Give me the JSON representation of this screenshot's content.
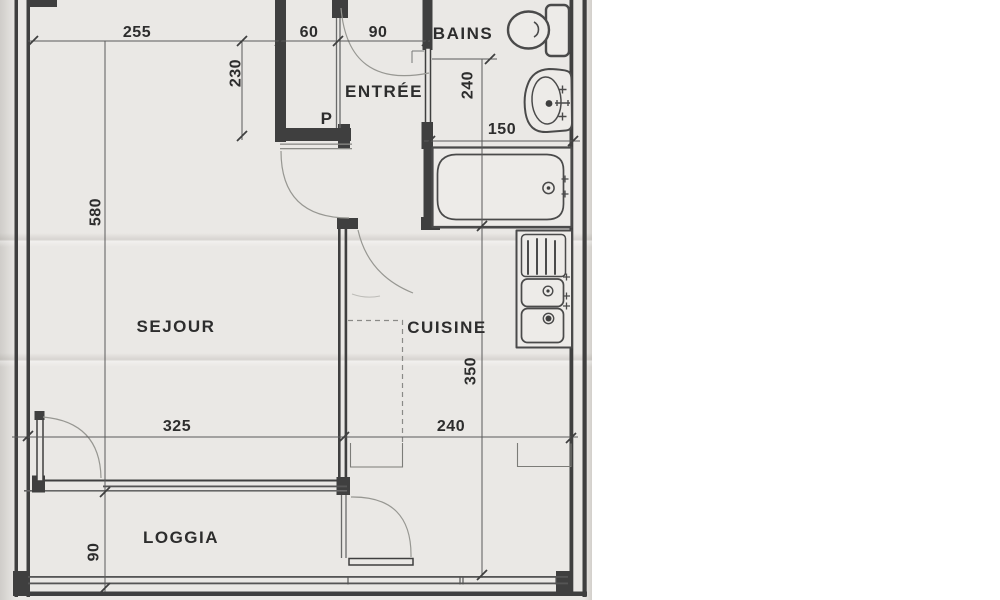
{
  "page": {
    "description": "Scanned architectural floor plan of an apartment"
  },
  "rooms": {
    "sejour": "SEJOUR",
    "cuisine": "CUISINE",
    "entree": "ENTRÉE",
    "bains": "BAINS",
    "loggia": "LOGGIA",
    "closet": "P"
  },
  "dims": {
    "w255": "255",
    "w60": "60",
    "w90": "90",
    "d230": "230",
    "d240": "240",
    "w150": "150",
    "h580": "580",
    "w325": "325",
    "w240": "240",
    "h350": "350",
    "d90": "90"
  },
  "colors": {
    "paper": "#eae8e5",
    "ink": "#3f3f3f",
    "dim_line": "#5a5a5a",
    "door_arc": "#979792"
  }
}
